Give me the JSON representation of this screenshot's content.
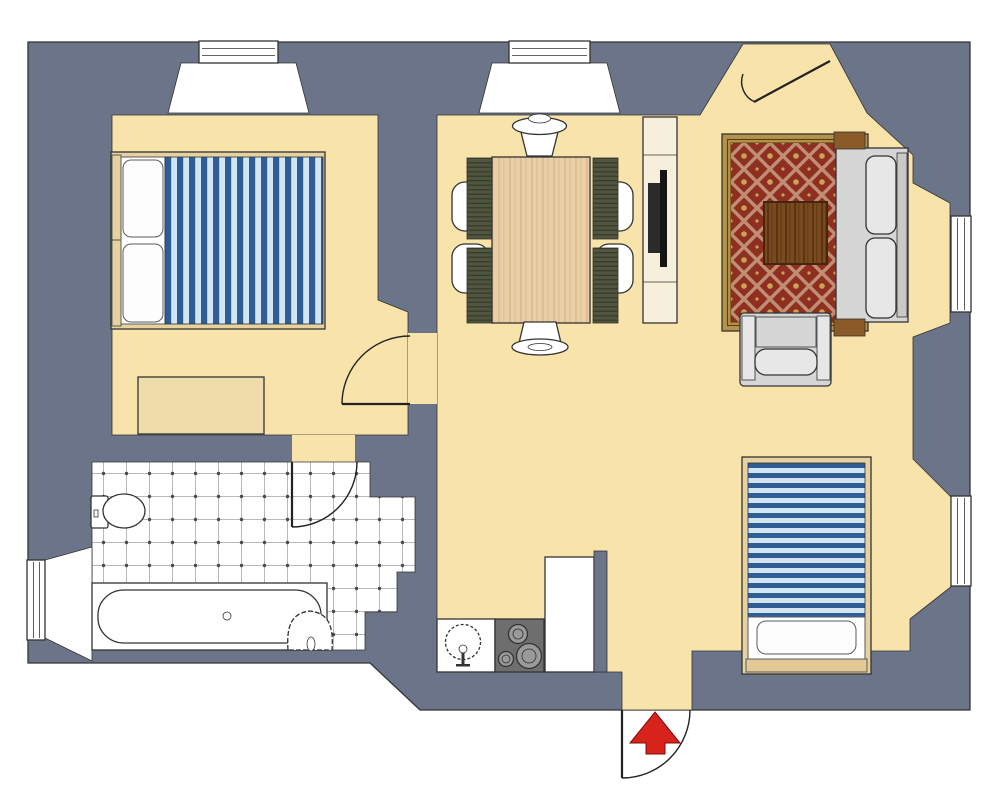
{
  "scene": {
    "label": "apartment-floor-plan",
    "width": 1000,
    "height": 812
  },
  "colors": {
    "wall": "#6b7489",
    "line": "#333333",
    "door_line": "#222222",
    "floor": "#f8e3ab",
    "fixture": "#ffffff",
    "console": "#f6efdc",
    "bed_frame": "#e6d1a0",
    "bed_plank": "#e2c995",
    "dresser": "#eedcab",
    "stripe_dark": "#2f5e97",
    "stripe_light": "#d3e4f2",
    "pillow": "#fdfdfd",
    "tile_line": "#b9b9b9",
    "tile_dot": "#4c4c4c",
    "rug_border": "#b5934c",
    "rug_edge": "#5b4012",
    "rug_field": "#8e2f22",
    "rug_lattice": "#c08e72",
    "rug_flower": "#caa452",
    "table_wood": "#e9cfa6",
    "table_grain": "#b07a46",
    "chair_olive": "#515640",
    "chair_stripe": "#3a3e2c",
    "seat": "#fcfcfc",
    "tv": "#2b2b2b",
    "sofa": "#d6d6d6",
    "sofa_back": "#c9c9c9",
    "cushion": "#e7e7e7",
    "arm_wood": "#8a5a28",
    "coffee_wood": "#7a4a1e",
    "stove": "#6e6e6e",
    "burner": "#9a9a9a",
    "arrow": "#d8231d"
  },
  "rooms": [
    {
      "id": "bedroom-1",
      "furniture": [
        "double-bed",
        "pillows",
        "striped-blanket",
        "dresser"
      ]
    },
    {
      "id": "dining-area",
      "furniture": [
        "dining-table",
        "side-chair",
        "side-chair",
        "side-chair",
        "side-chair",
        "head-chair",
        "foot-chair"
      ]
    },
    {
      "id": "living-area",
      "furniture": [
        "patterned-rug",
        "coffee-table",
        "sofa",
        "armchair",
        "tv-console",
        "tv"
      ]
    },
    {
      "id": "bedroom-2",
      "furniture": [
        "single-bed",
        "pillow",
        "striped-blanket"
      ]
    },
    {
      "id": "kitchen",
      "furniture": [
        "counter-with-sink",
        "stove",
        "tall-cabinet"
      ]
    },
    {
      "id": "bathroom",
      "furniture": [
        "bathtub",
        "toilet",
        "wash-basin",
        "tiled-floor"
      ]
    },
    {
      "id": "hallway",
      "furniture": []
    }
  ],
  "windows": [
    "bedroom-bay-window",
    "dining-bay-window",
    "living-room-window",
    "second-bedroom-window",
    "bathroom-window"
  ],
  "doors": [
    "main-entrance-top",
    "entrance-bottom-with-arrow",
    "bedroom-door",
    "bathroom-door"
  ],
  "symbols": {
    "entrance_arrow": "red-arrow-pointing-up"
  }
}
